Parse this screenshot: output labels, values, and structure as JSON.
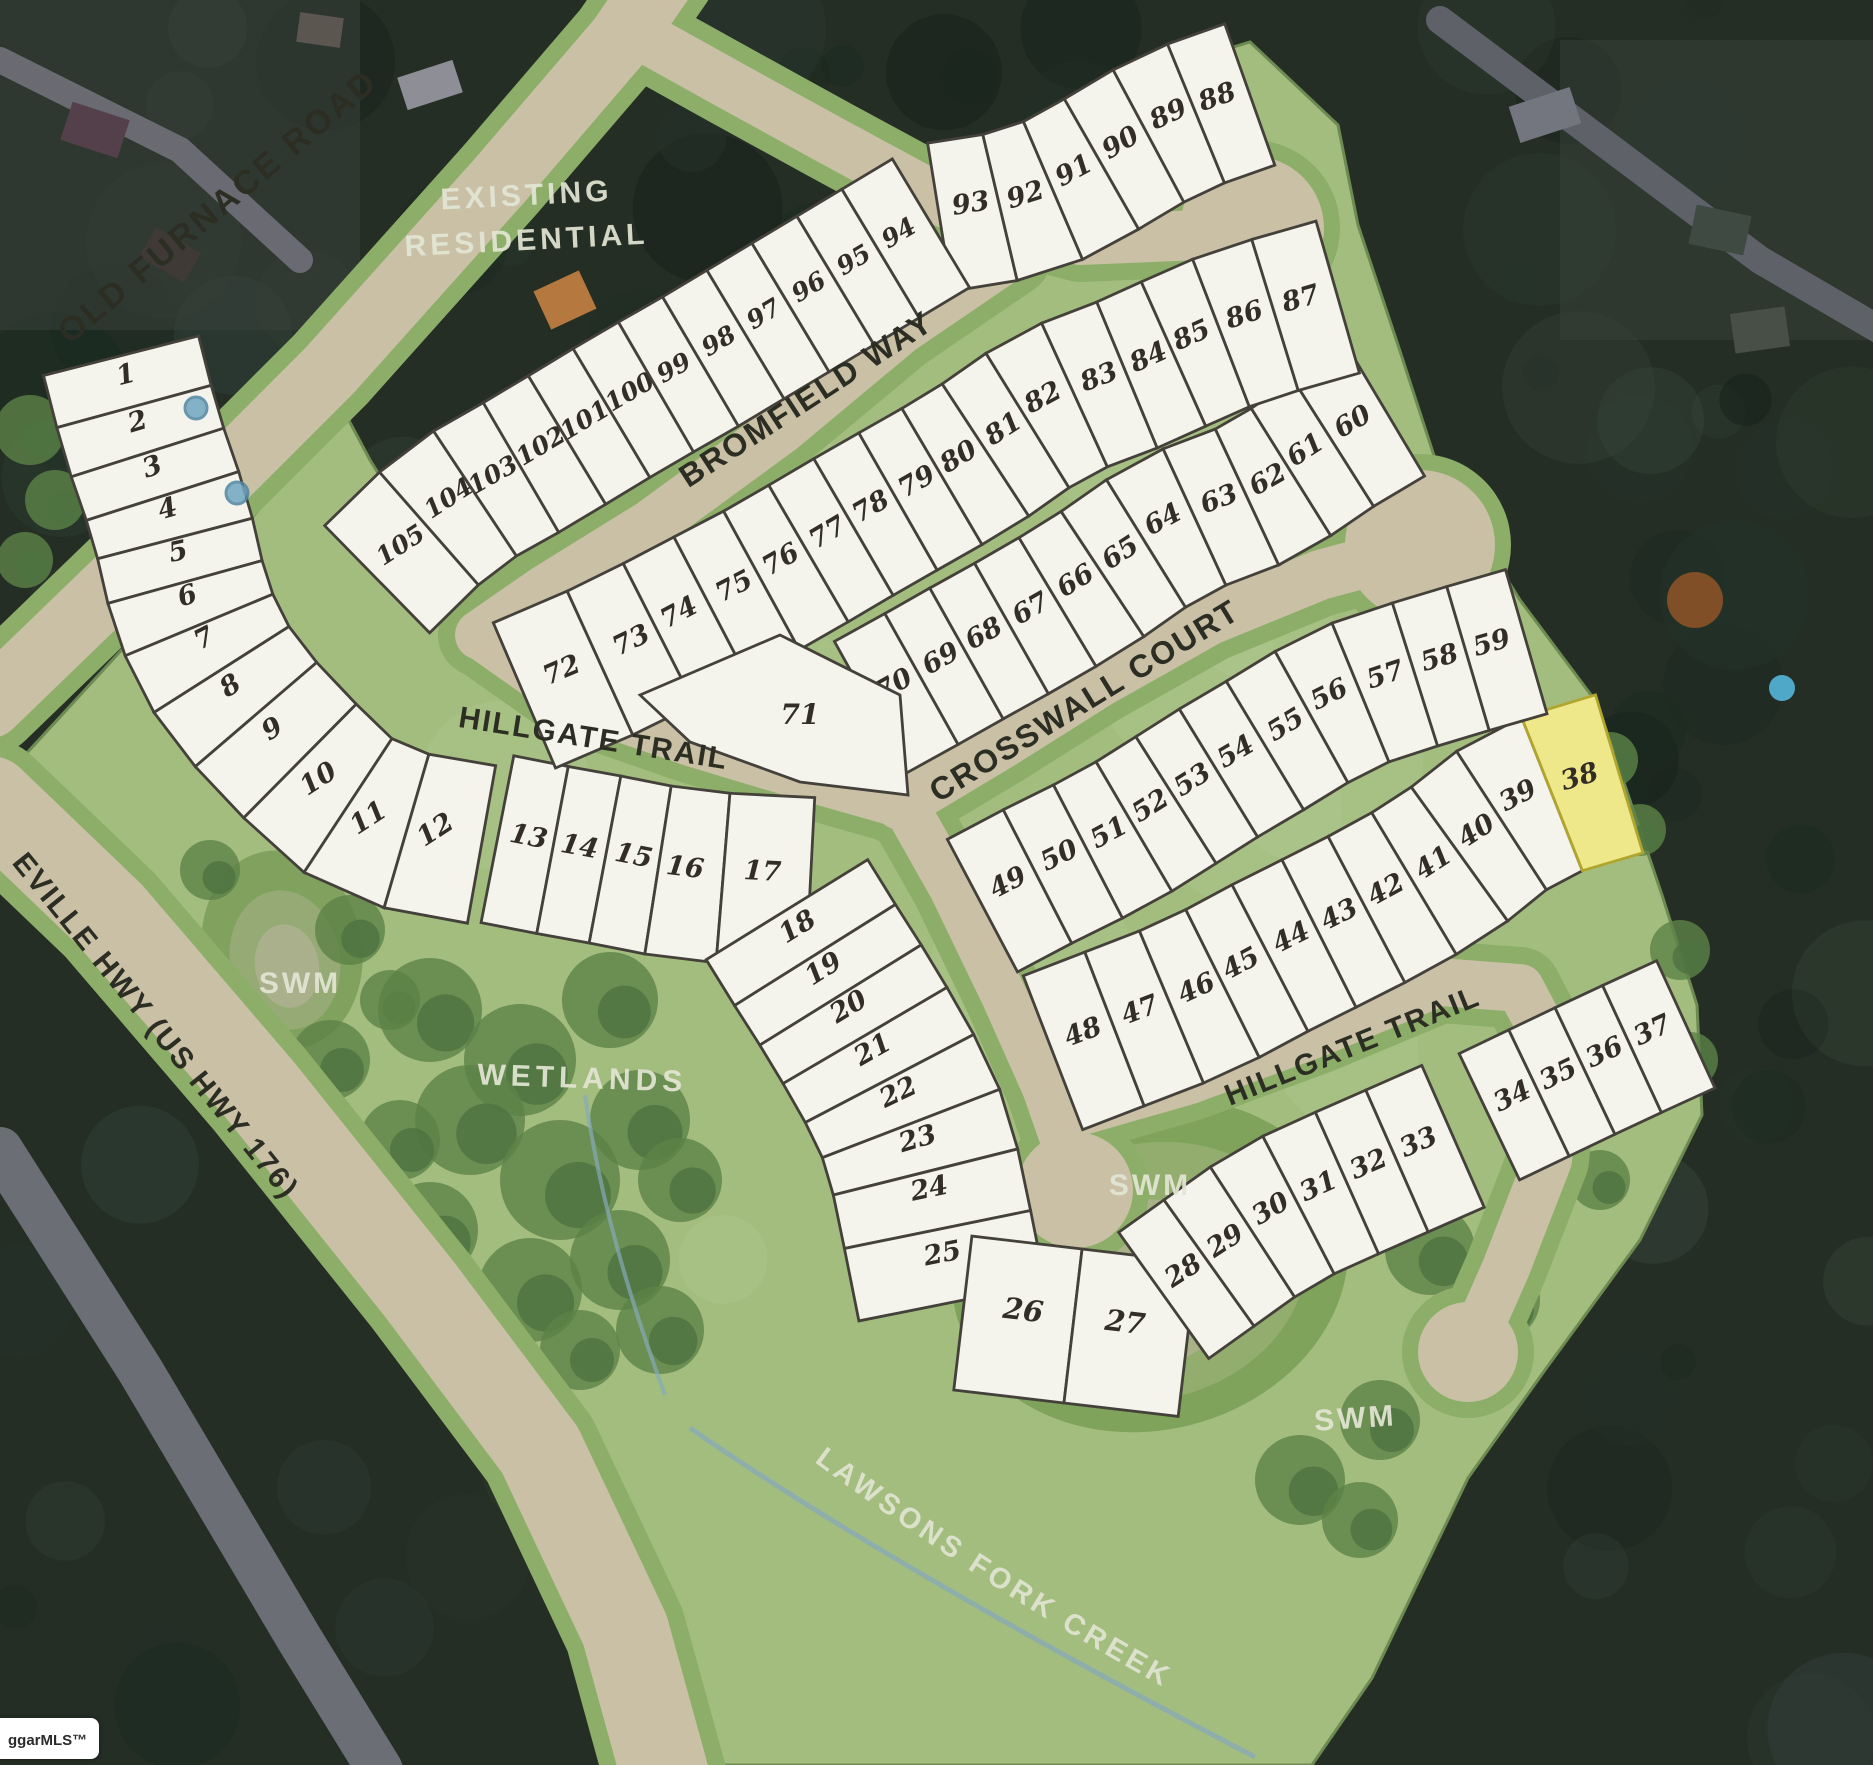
{
  "map": {
    "watermark": "ggarMLS™",
    "highlight": {
      "lot": 38,
      "color": "#efe88a",
      "edge": "#b0a62e"
    },
    "colors": {
      "aerial_base": "#242e25",
      "parcel_green": "#a3bd7f",
      "parcel_edge": "#6d8a52",
      "road_pavement": "#c9c0a6",
      "road_verge": "#8cae68",
      "lot_fill": "#f4f3ec",
      "lot_line": "#44403a",
      "lot_number": "#332d27",
      "street_text": "#2c2e24",
      "area_text": "#e3e6d4",
      "water": "#86a9ba"
    },
    "street_labels": [
      {
        "id": "old-furnace-road",
        "text": "OLD FURNACE ROAD",
        "x": 225,
        "y": 215,
        "rot": -40,
        "size": 34,
        "ls": 3
      },
      {
        "id": "bromfield-way",
        "text": "BROMFIELD WAY",
        "x": 812,
        "y": 408,
        "rot": -33,
        "size": 32,
        "ls": 2
      },
      {
        "id": "hillgate-trail-west",
        "text": "HILLGATE TRAIL",
        "x": 592,
        "y": 748,
        "rot": 9,
        "size": 30,
        "ls": 2
      },
      {
        "id": "crosswall-court",
        "text": "CROSSWALL COURT",
        "x": 1090,
        "y": 710,
        "rot": -31.5,
        "size": 32,
        "ls": 2
      },
      {
        "id": "hillgate-trail-east",
        "text": "HILLGATE TRAIL",
        "x": 1356,
        "y": 1055,
        "rot": -22,
        "size": 30,
        "ls": 2
      },
      {
        "id": "asheville-hwy",
        "text": "EVILLE HWY (US HWY 176)",
        "x": 148,
        "y": 1032,
        "rot": 51,
        "size": 30,
        "ls": 2
      }
    ],
    "area_labels": [
      {
        "id": "existing-residential-line1",
        "text": "EXISTING",
        "x": 527,
        "y": 205,
        "rot": -3,
        "size": 30,
        "ls": 4
      },
      {
        "id": "existing-residential-line2",
        "text": "RESIDENTIAL",
        "x": 527,
        "y": 250,
        "rot": -3,
        "size": 30,
        "ls": 4
      },
      {
        "id": "swm-west",
        "text": "SWM",
        "x": 300,
        "y": 993,
        "rot": 0,
        "size": 30,
        "ls": 3
      },
      {
        "id": "wetlands",
        "text": "WETLANDS",
        "x": 582,
        "y": 1088,
        "rot": 2,
        "size": 30,
        "ls": 5
      },
      {
        "id": "swm-east",
        "text": "SWM",
        "x": 1150,
        "y": 1195,
        "rot": 0,
        "size": 30,
        "ls": 3
      },
      {
        "id": "swm-southeast",
        "text": "SWM",
        "x": 1356,
        "y": 1428,
        "rot": -4,
        "size": 30,
        "ls": 3
      }
    ],
    "creek_label": {
      "id": "lawsons-fork-creek",
      "text": "LAWSONS FORK CREEK",
      "size": 29,
      "ls": 4
    },
    "lot_rows": [
      {
        "id": "row-1-12",
        "depth": 160,
        "rotOff": -90,
        "fs": 27,
        "lots": [
          [
            1,
            128,
            383
          ],
          [
            2,
            140,
            430
          ],
          [
            3,
            155,
            475
          ],
          [
            4,
            170,
            517
          ],
          [
            5,
            180,
            560
          ],
          [
            6,
            190,
            604
          ],
          [
            7,
            208,
            646
          ],
          [
            8,
            235,
            693
          ],
          [
            9,
            277,
            736
          ],
          [
            10,
            323,
            786
          ],
          [
            11,
            373,
            825
          ],
          [
            12,
            440,
            837
          ]
        ]
      },
      {
        "id": "row-13-17",
        "depth": 170,
        "rotOff": 0,
        "fs": 27,
        "lots": [
          [
            13,
            527,
            845
          ],
          [
            14,
            578,
            855
          ],
          [
            15,
            632,
            864
          ],
          [
            16,
            684,
            876
          ],
          [
            17,
            762,
            880
          ]
        ]
      },
      {
        "id": "row-18-25",
        "depth": 190,
        "rotOff": -90,
        "fs": 27,
        "lots": [
          [
            18,
            802,
            934
          ],
          [
            19,
            828,
            976
          ],
          [
            20,
            853,
            1014
          ],
          [
            21,
            877,
            1057
          ],
          [
            22,
            902,
            1100
          ],
          [
            23,
            920,
            1147
          ],
          [
            24,
            931,
            1197
          ],
          [
            25,
            944,
            1262
          ]
        ]
      },
      {
        "id": "row-26-27",
        "depth": 155,
        "rotOff": 0,
        "fs": 29,
        "lots": [
          [
            26,
            1022,
            1320
          ],
          [
            27,
            1124,
            1332
          ]
        ]
      },
      {
        "id": "row-28-33",
        "depth": 155,
        "rotOff": 0,
        "fs": 27,
        "lots": [
          [
            28,
            1188,
            1278
          ],
          [
            29,
            1230,
            1248
          ],
          [
            30,
            1275,
            1216
          ],
          [
            31,
            1322,
            1194
          ],
          [
            32,
            1372,
            1172
          ],
          [
            33,
            1422,
            1150
          ]
        ]
      },
      {
        "id": "row-34-37",
        "depth": 140,
        "rotOff": 0,
        "fs": 27,
        "lots": [
          [
            34,
            1516,
            1104
          ],
          [
            35,
            1562,
            1082
          ],
          [
            36,
            1608,
            1060
          ],
          [
            37,
            1656,
            1038
          ]
        ]
      },
      {
        "id": "row-38-48",
        "depth": 165,
        "rotOff": 0,
        "fs": 27,
        "lots": [
          [
            48,
            1086,
            1040
          ],
          [
            47,
            1143,
            1018
          ],
          [
            46,
            1200,
            996
          ],
          [
            45,
            1245,
            971
          ],
          [
            44,
            1295,
            945
          ],
          [
            43,
            1343,
            922
          ],
          [
            42,
            1390,
            897
          ],
          [
            41,
            1438,
            870
          ],
          [
            40,
            1481,
            838
          ],
          [
            39,
            1522,
            803
          ],
          [
            38,
            1582,
            785
          ]
        ]
      },
      {
        "id": "row-49-59",
        "depth": 150,
        "rotOff": 0,
        "fs": 27,
        "lots": [
          [
            49,
            1012,
            890
          ],
          [
            50,
            1063,
            863
          ],
          [
            51,
            1113,
            840
          ],
          [
            52,
            1155,
            813
          ],
          [
            53,
            1197,
            787
          ],
          [
            54,
            1240,
            759
          ],
          [
            55,
            1290,
            732
          ],
          [
            56,
            1333,
            702
          ],
          [
            57,
            1388,
            683
          ],
          [
            58,
            1442,
            666
          ],
          [
            59,
            1494,
            651
          ]
        ]
      },
      {
        "id": "row-60-70",
        "depth": 150,
        "rotOff": 0,
        "fs": 27,
        "lots": [
          [
            70,
            898,
            692
          ],
          [
            69,
            945,
            666
          ],
          [
            68,
            988,
            641
          ],
          [
            67,
            1035,
            616
          ],
          [
            66,
            1080,
            588
          ],
          [
            65,
            1125,
            560
          ],
          [
            64,
            1167,
            527
          ],
          [
            63,
            1222,
            507
          ],
          [
            62,
            1272,
            487
          ],
          [
            61,
            1310,
            457
          ],
          [
            60,
            1357,
            429
          ]
        ]
      },
      {
        "id": "row-72-87",
        "depth": 158,
        "rotOff": 0,
        "fs": 27,
        "lots": [
          [
            72,
            565,
            678
          ],
          [
            73,
            635,
            648
          ],
          [
            74,
            683,
            620
          ],
          [
            75,
            738,
            594
          ],
          [
            76,
            785,
            567
          ],
          [
            77,
            832,
            540
          ],
          [
            78,
            875,
            514
          ],
          [
            79,
            921,
            489
          ],
          [
            80,
            963,
            464
          ],
          [
            81,
            1008,
            436
          ],
          [
            82,
            1047,
            405
          ],
          [
            83,
            1102,
            385
          ],
          [
            84,
            1152,
            365
          ],
          [
            85,
            1195,
            343
          ],
          [
            86,
            1247,
            323
          ],
          [
            87,
            1303,
            307
          ]
        ]
      },
      {
        "id": "row-88-93",
        "depth": 150,
        "rotOff": 0,
        "fs": 27,
        "lots": [
          [
            93,
            972,
            212
          ],
          [
            92,
            1028,
            203
          ],
          [
            91,
            1078,
            178
          ],
          [
            90,
            1125,
            150
          ],
          [
            89,
            1172,
            122
          ],
          [
            88,
            1220,
            105
          ]
        ]
      },
      {
        "id": "row-94-105",
        "depth": 150,
        "rotOff": 0,
        "fs": 25,
        "lots": [
          [
            105,
            405,
            552
          ],
          [
            104,
            453,
            505
          ],
          [
            103,
            497,
            482
          ],
          [
            102,
            545,
            453
          ],
          [
            101,
            589,
            427
          ],
          [
            100,
            634,
            399
          ],
          [
            99,
            678,
            375
          ],
          [
            98,
            723,
            348
          ],
          [
            97,
            768,
            321
          ],
          [
            96,
            813,
            294
          ],
          [
            95,
            858,
            267
          ],
          [
            94,
            903,
            240
          ]
        ]
      }
    ],
    "special_lots": [
      {
        "n": 71,
        "points": [
          [
            640,
            695
          ],
          [
            780,
            635
          ],
          [
            900,
            695
          ],
          [
            908,
            795
          ],
          [
            800,
            782
          ],
          [
            690,
            742
          ]
        ],
        "label": [
          800,
          724
        ],
        "fs": 28
      }
    ]
  }
}
